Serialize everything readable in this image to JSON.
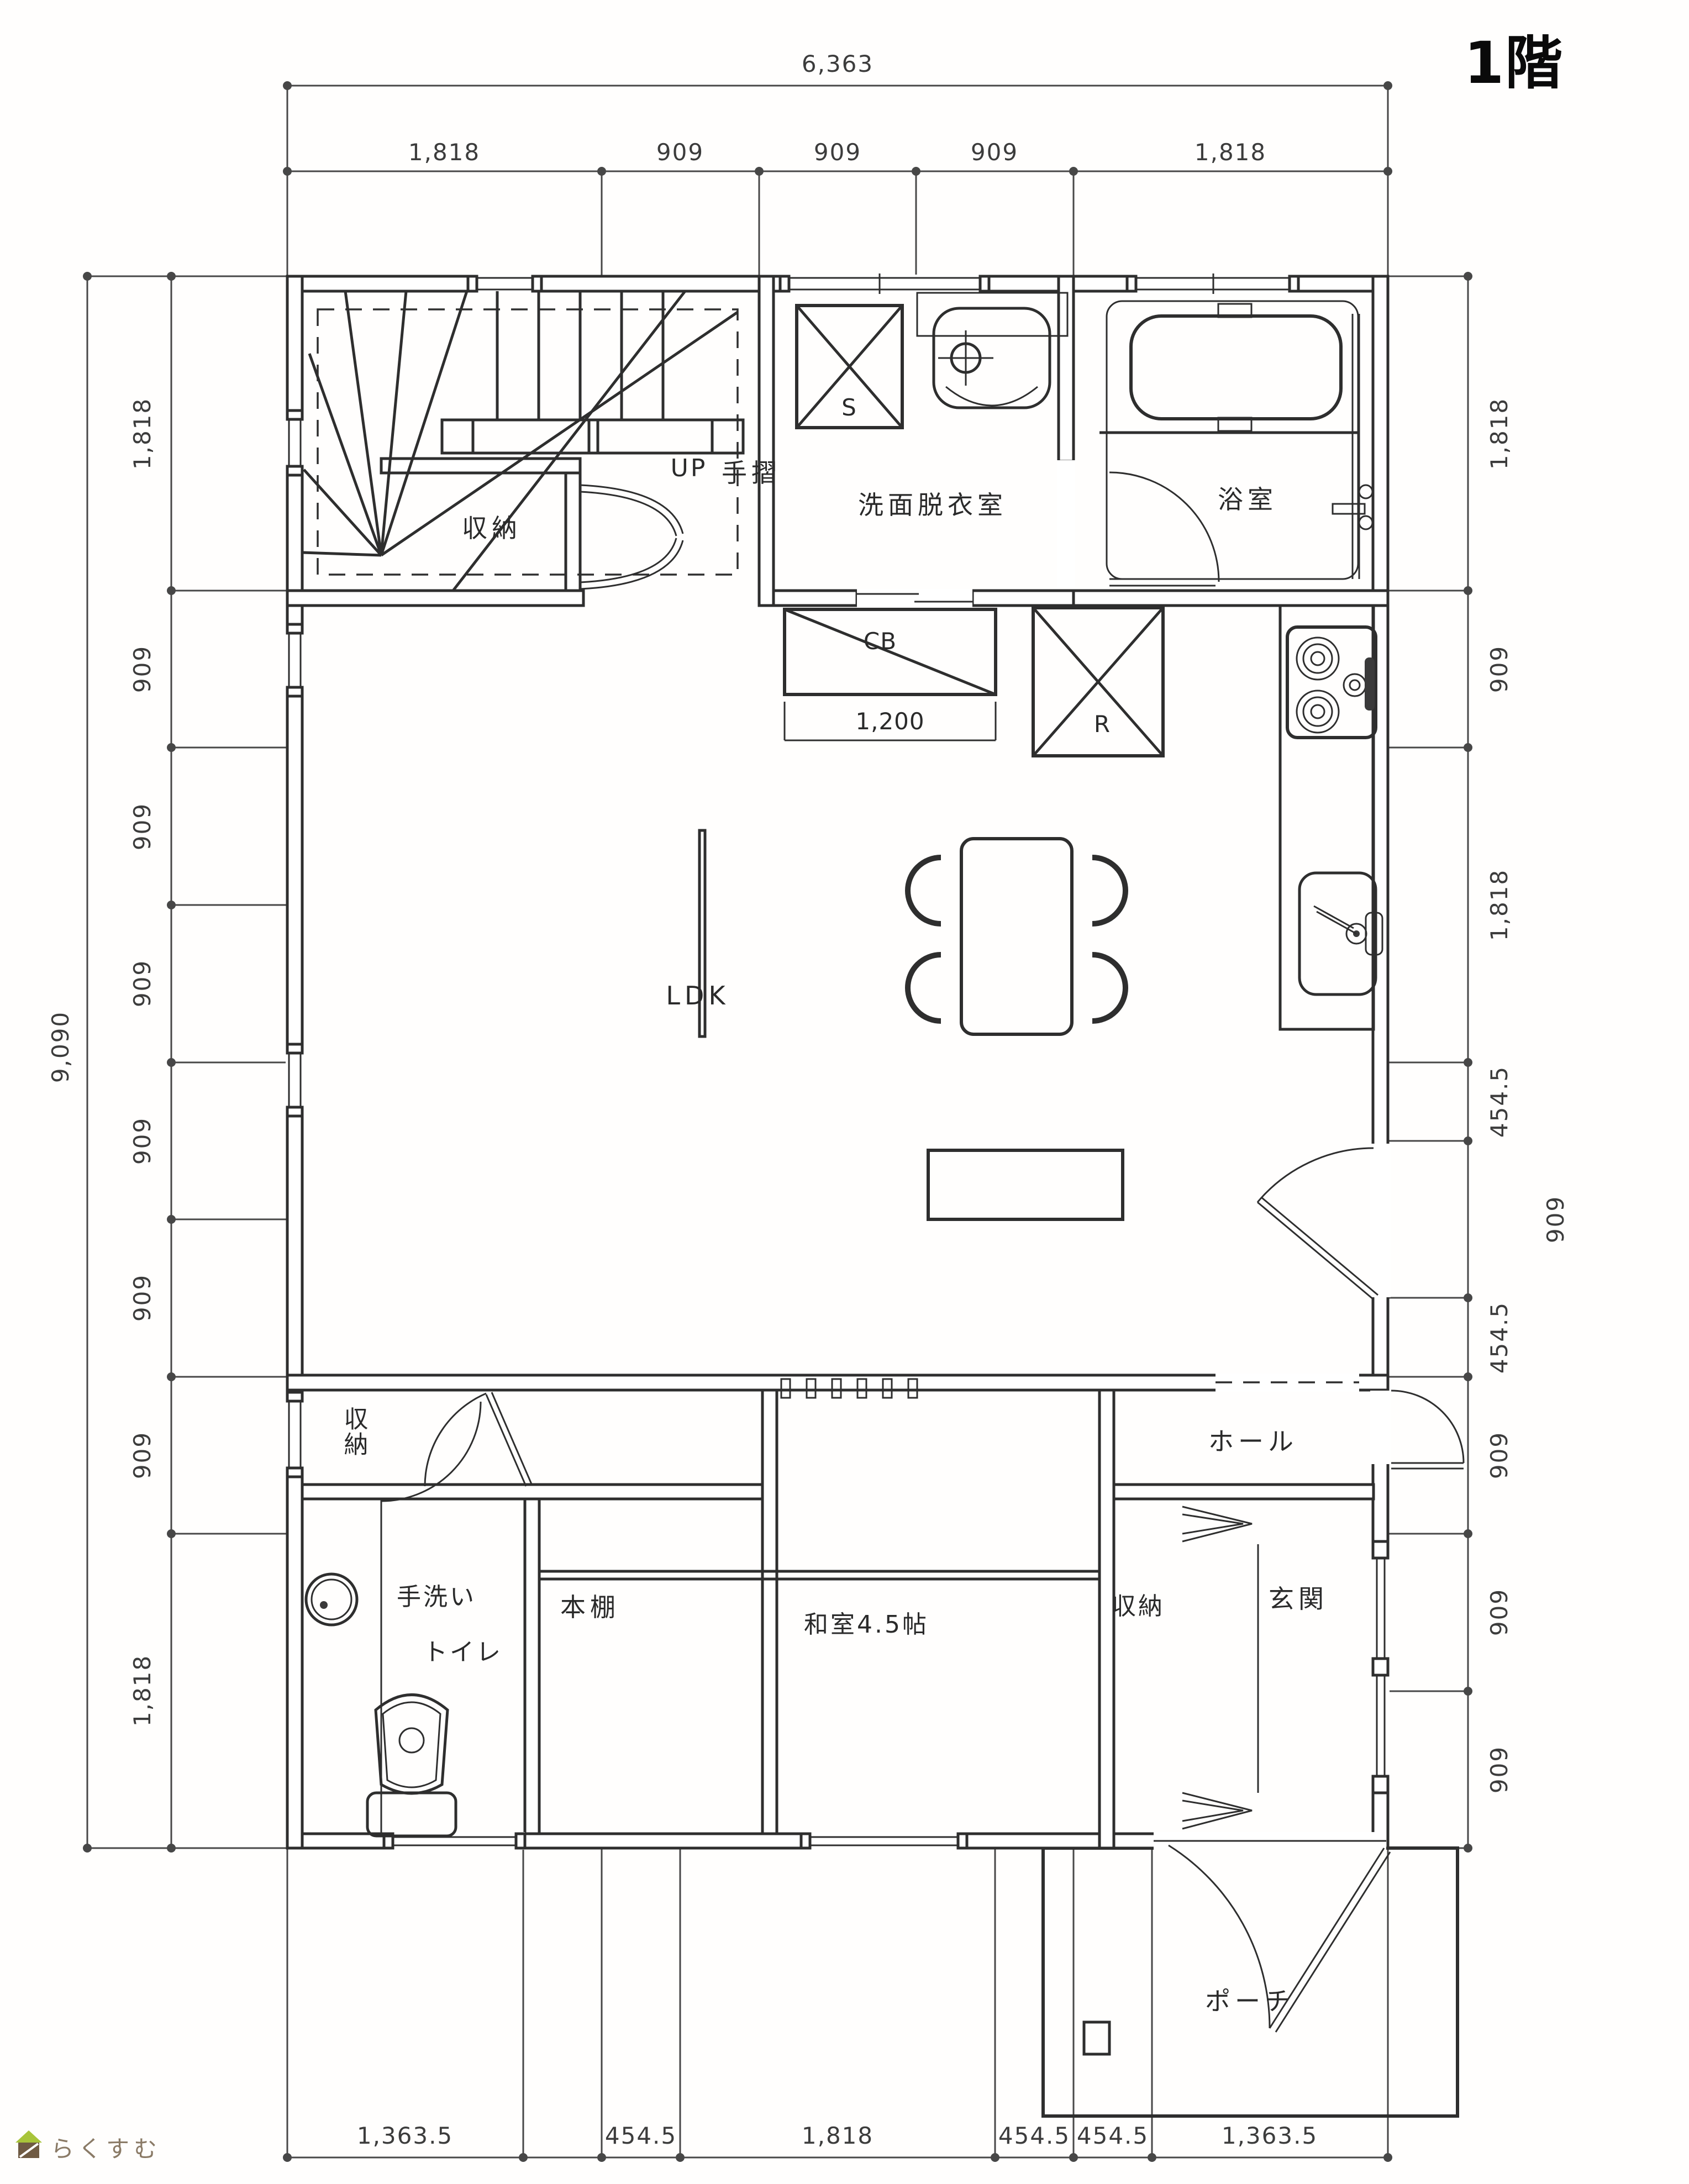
{
  "title": "1階",
  "logo": {
    "brand": "らくすむ"
  },
  "rooms": {
    "stair_storage": "収納",
    "up": "UP",
    "handrail": "手摺",
    "washroom": "洗面脱衣室",
    "bathroom": "浴室",
    "ldk": "LDK",
    "vestibule_storage": "収納",
    "hand_wash": "手洗い",
    "toilet": "トイレ",
    "bookshelf": "本棚",
    "washitsu": "和室4.5帖",
    "hall": "ホール",
    "entrance_storage": "収納",
    "entrance": "玄関",
    "porch": "ポーチ"
  },
  "fixtures": {
    "washer": "S",
    "counter": "CB",
    "counter_width": "1,200",
    "fridge": "R"
  },
  "dims": {
    "top_total": "6,363",
    "top": [
      "1,818",
      "909",
      "909",
      "909",
      "1,818"
    ],
    "left_total": "9,090",
    "left": [
      "1,818",
      "909",
      "909",
      "909",
      "909",
      "909",
      "909",
      "1,818"
    ],
    "right": [
      "1,818",
      "909",
      "1,818",
      "454.5",
      "909",
      "454.5",
      "909",
      "909",
      "909"
    ],
    "bottom": [
      "1,363.5",
      "454.5",
      "454.5",
      "1,818",
      "454.5",
      "454.5",
      "1,363.5"
    ]
  },
  "colors": {
    "line": "#2e2e2e",
    "dimension": "#474747",
    "paper": "#ffffff",
    "logo_green": "#a8c43a",
    "logo_brown": "#6f5a43"
  }
}
